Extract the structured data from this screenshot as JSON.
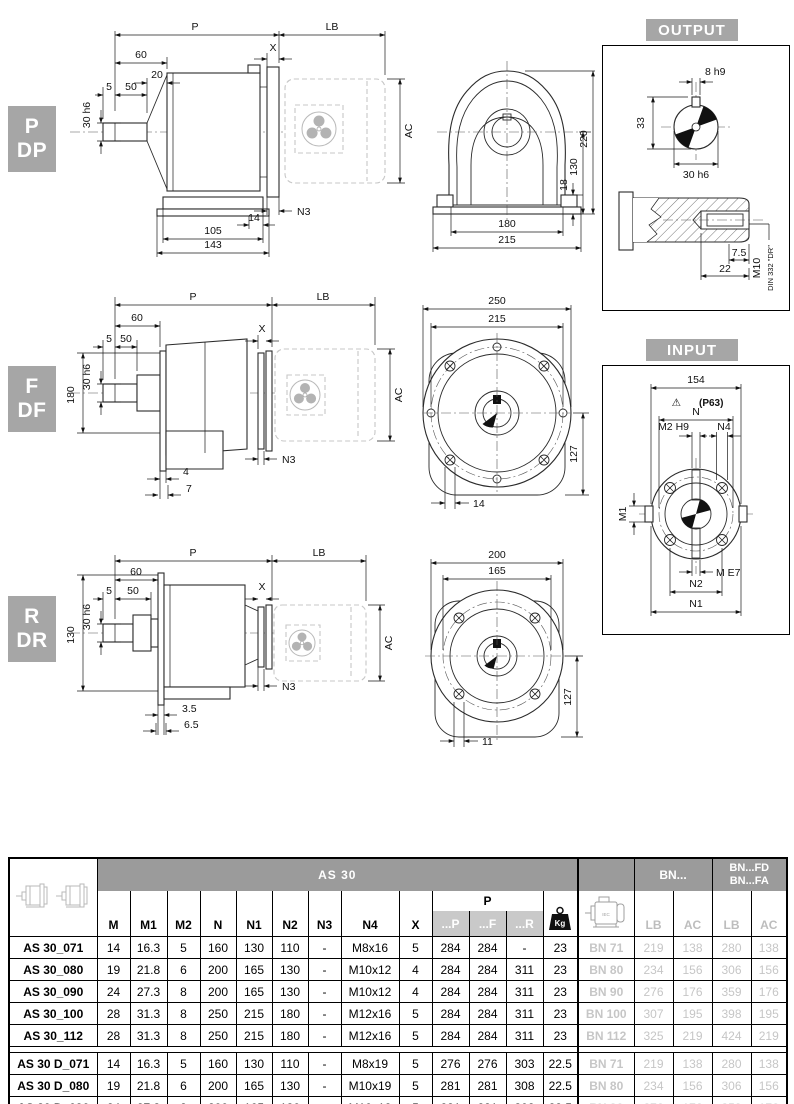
{
  "badges": {
    "pdp": {
      "line1": "P",
      "line2": "DP"
    },
    "fdf": {
      "line1": "F",
      "line2": "DF"
    },
    "rdr": {
      "line1": "R",
      "line2": "DR"
    }
  },
  "panels": {
    "output_title": "OUTPUT",
    "input_title": "INPUT"
  },
  "drawing_pdp": {
    "dim_p": "P",
    "dim_lb": "LB",
    "dim_60": "60",
    "dim_20": "20",
    "dim_x": "X",
    "dim_5": "5",
    "dim_50": "50",
    "dim_shaft": "30 h6",
    "dim_ac": "AC",
    "dim_n3": "N3",
    "dim_14": "14",
    "dim_105": "105",
    "dim_143": "143",
    "front": {
      "dim_220": "220",
      "dim_130": "130",
      "dim_18": "18",
      "dim_180": "180",
      "dim_215": "215"
    }
  },
  "drawing_fdf": {
    "dim_p": "P",
    "dim_lb": "LB",
    "dim_60": "60",
    "dim_x": "X",
    "dim_5": "5",
    "dim_50": "50",
    "dim_shaft": "30 h6",
    "dim_180": "180",
    "dim_ac": "AC",
    "dim_n3": "N3",
    "dim_4": "4",
    "dim_7": "7",
    "front": {
      "dim_250": "250",
      "dim_215": "215",
      "dim_127": "127",
      "dim_14": "14"
    }
  },
  "drawing_rdr": {
    "dim_p": "P",
    "dim_lb": "LB",
    "dim_60": "60",
    "dim_x": "X",
    "dim_5": "5",
    "dim_50": "50",
    "dim_shaft": "30 h6",
    "dim_130": "130",
    "dim_ac": "AC",
    "dim_n3": "N3",
    "dim_35": "3.5",
    "dim_65": "6.5",
    "front": {
      "dim_200": "200",
      "dim_165": "165",
      "dim_127": "127",
      "dim_11": "11"
    }
  },
  "output_panel": {
    "dim_key": "8 h9",
    "dim_33": "33",
    "dim_shaft": "30 h6",
    "dim_75": "7.5",
    "dim_22": "22",
    "label_m10": "M10",
    "label_din": "DIN 332 \"DR\""
  },
  "input_panel": {
    "dim_154": "154",
    "warn_icon": "⚠",
    "warn": "(P63)",
    "dim_n": "N",
    "dim_m2": "M2 H9",
    "dim_n4": "N4",
    "dim_m1": "M1",
    "dim_me7": "M E7",
    "dim_n2": "N2",
    "dim_n1": "N1"
  },
  "table": {
    "title": "AS 30",
    "dim_headers": [
      "M",
      "M1",
      "M2",
      "N",
      "N1",
      "N2",
      "N3",
      "N4",
      "X"
    ],
    "p_group_label": "P",
    "p_sub_headers": [
      "...P",
      "...F",
      "...R"
    ],
    "kg_label": "Kg",
    "bn_label": "BN...",
    "bnfd_line1": "BN...FD",
    "bnfd_line2": "BN...FA",
    "motor_sub_headers": [
      "LB",
      "AC",
      "LB",
      "AC"
    ],
    "motor_icon_label": "IEC",
    "rows_group1": [
      [
        "AS 30_071",
        "14",
        "16.3",
        "5",
        "160",
        "130",
        "110",
        "-",
        "M8x16",
        "5",
        "284",
        "284",
        "-",
        "23",
        "BN 71",
        "219",
        "138",
        "280",
        "138"
      ],
      [
        "AS 30_080",
        "19",
        "21.8",
        "6",
        "200",
        "165",
        "130",
        "-",
        "M10x12",
        "4",
        "284",
        "284",
        "311",
        "23",
        "BN 80",
        "234",
        "156",
        "306",
        "156"
      ],
      [
        "AS 30_090",
        "24",
        "27.3",
        "8",
        "200",
        "165",
        "130",
        "-",
        "M10x12",
        "4",
        "284",
        "284",
        "311",
        "23",
        "BN 90",
        "276",
        "176",
        "359",
        "176"
      ],
      [
        "AS 30_100",
        "28",
        "31.3",
        "8",
        "250",
        "215",
        "180",
        "-",
        "M12x16",
        "5",
        "284",
        "284",
        "311",
        "23",
        "BN 100",
        "307",
        "195",
        "398",
        "195"
      ],
      [
        "AS 30_112",
        "28",
        "31.3",
        "8",
        "250",
        "215",
        "180",
        "-",
        "M12x16",
        "5",
        "284",
        "284",
        "311",
        "23",
        "BN 112",
        "325",
        "219",
        "424",
        "219"
      ]
    ],
    "rows_group2": [
      [
        "AS 30 D_071",
        "14",
        "16.3",
        "5",
        "160",
        "130",
        "110",
        "-",
        "M8x19",
        "5",
        "276",
        "276",
        "303",
        "22.5",
        "BN 71",
        "219",
        "138",
        "280",
        "138"
      ],
      [
        "AS 30 D_080",
        "19",
        "21.8",
        "6",
        "200",
        "165",
        "130",
        "-",
        "M10x19",
        "5",
        "281",
        "281",
        "308",
        "22.5",
        "BN 80",
        "234",
        "156",
        "306",
        "156"
      ],
      [
        "AS 30 D_090",
        "24",
        "27.3",
        "8",
        "200",
        "165",
        "130",
        "-",
        "M10x12",
        "5",
        "281",
        "281",
        "308",
        "22.5",
        "BN 90",
        "276",
        "176",
        "359",
        "176"
      ]
    ]
  }
}
